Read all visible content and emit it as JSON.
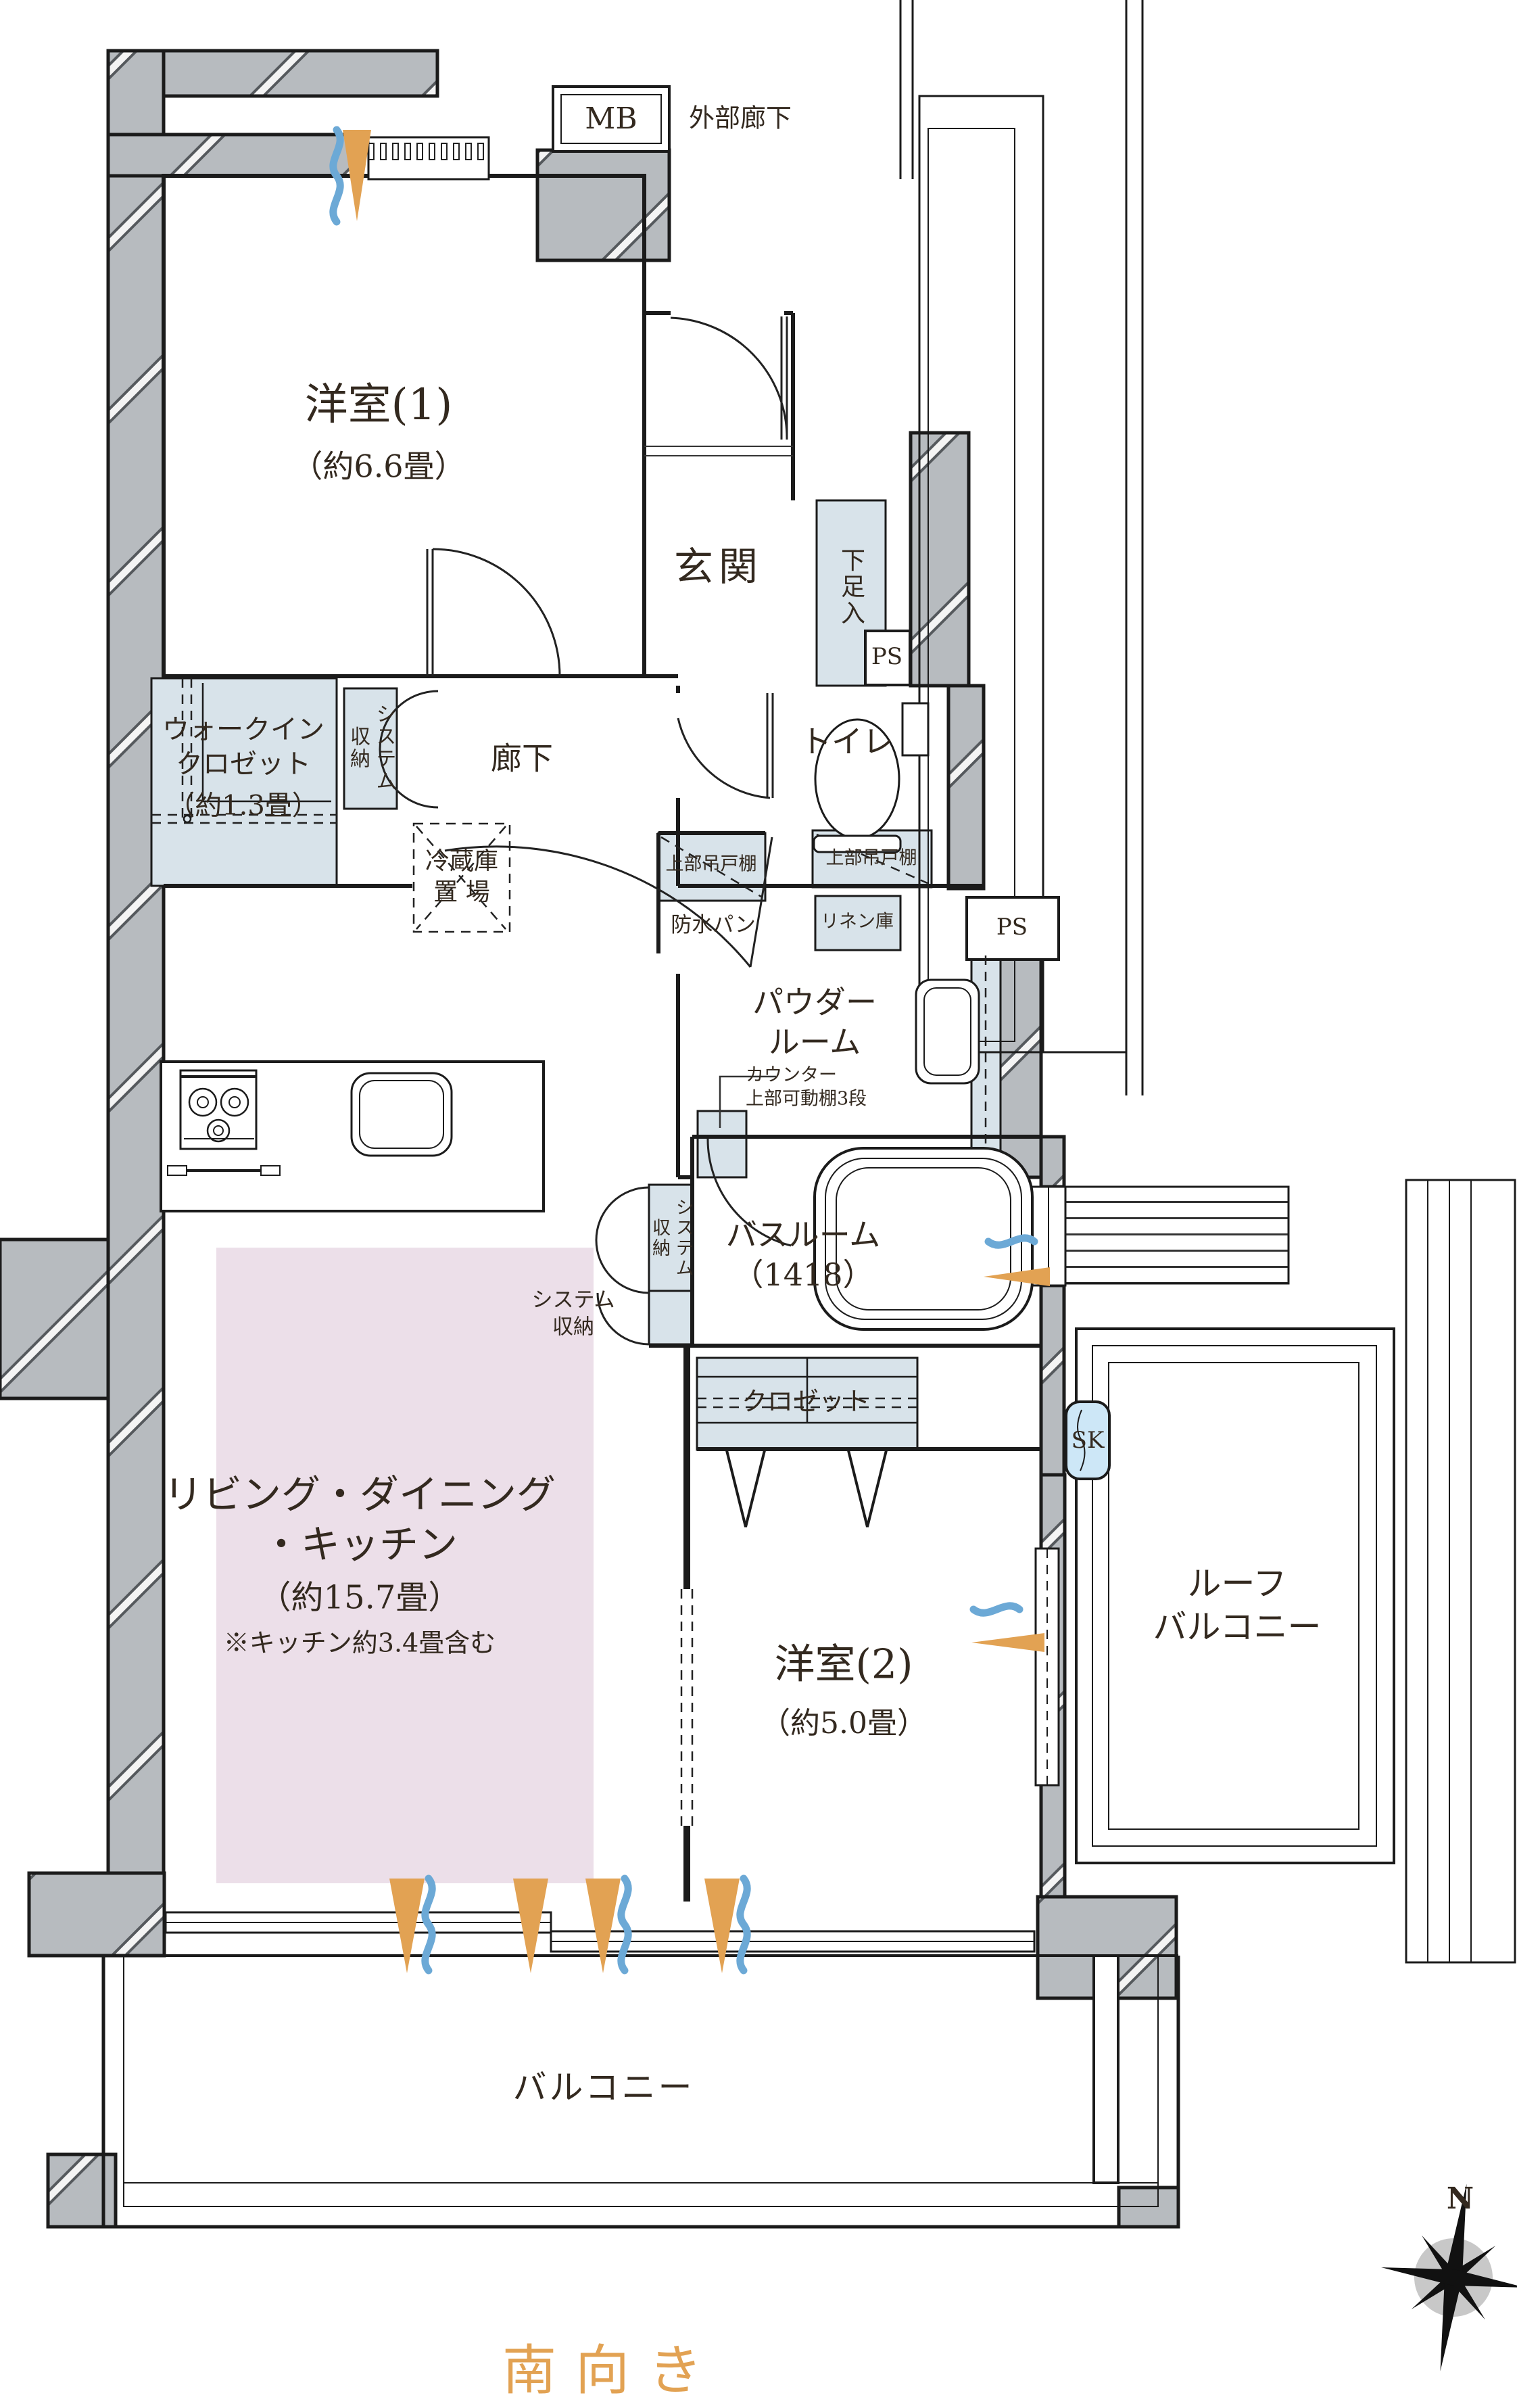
{
  "colors": {
    "wall": "#b7bbbf",
    "storage": "#d8e3ea",
    "sk": "#cde7f7",
    "ldk": "#ecdfe9",
    "orange": "#e2a253",
    "blue": "#6ca9d6",
    "text": "#33291f",
    "line": "#1b1b1b"
  },
  "labels": {
    "mb": "MB",
    "exterior_corridor": "外部廊下",
    "room1_name": "洋室(1)",
    "room1_size": "（約6.6畳）",
    "entrance": "玄関",
    "shoe_cabinet": "下足入",
    "ps_upper": "PS",
    "wic_name": "ウォークイン\nクロゼット",
    "wic_size": "（約1.3畳）",
    "system_storage_1": "システム\n収納",
    "hallway": "廊下",
    "toilet": "トイレ",
    "fridge_space": "冷蔵庫\n置 場",
    "upper_cabinet_left": "上部吊戸棚",
    "waterproof_pan": "防水パン",
    "upper_cabinet_right": "上部吊戸棚",
    "linen_cabinet": "リネン庫",
    "ps_lower": "PS",
    "powder_room": "パウダー\nルーム",
    "counter_note": "カウンター\n上部可動棚3段",
    "bathroom": "バスルーム\n（1418）",
    "system_storage_2": "システム\n収納",
    "system_storage_3": "システム\n収納",
    "closet": "クロゼット",
    "sk": "SK",
    "ldk_name": "リビング・ダイニング\n・キッチン",
    "ldk_size": "（約15.7畳）",
    "ldk_note": "※キッチン約3.4畳含む",
    "room2_name": "洋室(2)",
    "room2_size": "（約5.0畳）",
    "roof_balcony": "ルーフ\nバルコニー",
    "balcony": "バルコニー",
    "facing": "南向き",
    "compass_north": "N"
  }
}
